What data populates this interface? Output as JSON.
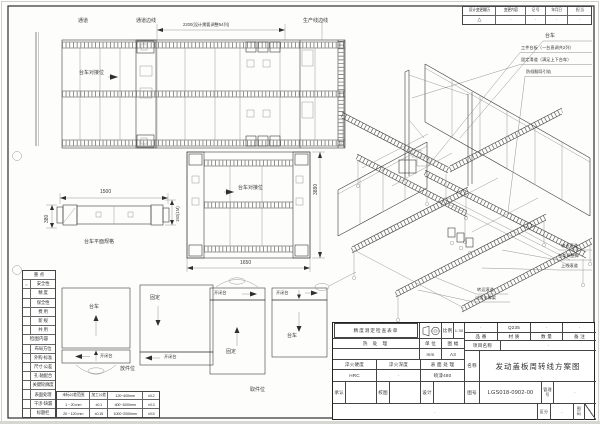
{
  "drawing": {
    "top_plan": {
      "label_passage": "通道",
      "label_passage_edge": "通道边线",
      "dim_2200": "2200(设计需要调整54列)",
      "label_production_edge": "生产线边线",
      "dock_label": "台车对接位"
    },
    "mid_plan": {
      "dock_label": "台车对接位",
      "dim_width": "1650",
      "dim_height": "3880"
    },
    "trolley_detail": {
      "dim_length": "1500",
      "dim_side": "380",
      "dim_end": "150(1M)",
      "caption": "台车平面规格"
    },
    "iso": {
      "callout_trolley": "台车",
      "callout_platform": "工件台板（一台直调共2列）",
      "callout_slide": "固定滑道（满足上下台车）",
      "callout_guide": "防倾翻导引轨",
      "callout_conveyor": "输送滚道",
      "callout_foot": "台架调整脚",
      "callout_online": "上线滚道",
      "callout_transfer": "转运滚道",
      "callout_support": "过渡支撑架"
    },
    "schematics": {
      "box1_label": "台车",
      "box2_label": "固定",
      "box3_label": "固定",
      "box4_label": "台车",
      "strip1": "开闭台",
      "strip2": "开闭台",
      "strip3": "开闭台",
      "strip4": "开闭台",
      "caption_left": "放件位",
      "caption_right": "取件位"
    }
  },
  "revision_table": {
    "headers": [
      "设计变更履历",
      "变更内容",
      "记 号",
      "年月日",
      "担 当"
    ],
    "values": [
      "△",
      "·",
      "·",
      "·",
      "·"
    ]
  },
  "checklist": {
    "header": "重  点",
    "mark": "○",
    "items": [
      "安全性",
      "精  度",
      "保全性",
      "费  用",
      "新  规",
      "共  用"
    ],
    "section": "检图内容",
    "items2": [
      "布局方位",
      "外购·标准",
      "尺寸·公差",
      "孔·轴配合",
      "关键轮廓度",
      "表面处理",
      "干涉·缺漏",
      "标题栏"
    ]
  },
  "tolerance_table": {
    "rows": [
      [
        "未标公差范围",
        "加工公差",
        "120~400mm",
        "±0.2"
      ],
      [
        "1 ~ 20 mm",
        "±0.1",
        "400~1000mm",
        "±0.3"
      ],
      [
        "20 ~ 120 mm",
        "±0.15",
        "1000~2000mm",
        "±0.5"
      ]
    ]
  },
  "title_block": {
    "check_header": "精度测定检查表单",
    "scale_label": "比例",
    "scale_value": "1:30",
    "heat_label": "热  处  理",
    "unit_label": "单 位",
    "unit_value": "mm",
    "sheet_label": "图 幅",
    "sheet_value": "A3",
    "part_label": "品 番",
    "part_value": "·",
    "mat_label": "材 质",
    "mat_value": "Q235",
    "qty_label": "数 量",
    "qty_value": "·",
    "note_label": "备 注",
    "note_value": "·",
    "project_label": "项目名称",
    "project_value": "·",
    "hard_label": "淬火硬度",
    "hard_value": "HRC",
    "depth_label": "淬火深度",
    "depth_value": "·",
    "surf_label": "表 面 处 理",
    "surf_value": "喷漆480",
    "name_label": "名称",
    "name_value": "发动盖板周转线方案图",
    "approve_label": "承认",
    "review_label": "校图",
    "design_label": "设计",
    "dwgno_label": "图号",
    "dwgno_value": "LGS018-0902-00",
    "mgmt_label": "管理号",
    "mgmt_value": "·",
    "class_label": "区分",
    "class_value": "·",
    "page_label": "图码",
    "footer_value": "·"
  }
}
